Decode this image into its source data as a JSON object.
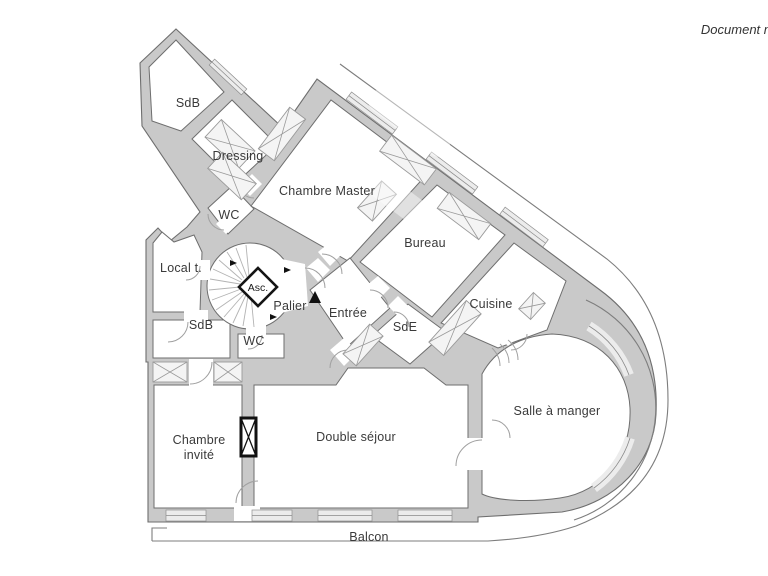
{
  "document": {
    "note": "Document n"
  },
  "colors": {
    "background": "#ffffff",
    "wall_fill": "#c9c9c9",
    "wall_edge": "#6e6e6e",
    "window_fill": "#ececec",
    "text": "#3a3a3a",
    "black": "#111111"
  },
  "rooms": [
    {
      "id": "sdb-top",
      "label": "SdB"
    },
    {
      "id": "dressing",
      "label": "Dressing"
    },
    {
      "id": "chambre-master",
      "label": "Chambre Master"
    },
    {
      "id": "wc-top",
      "label": "WC"
    },
    {
      "id": "bureau",
      "label": "Bureau"
    },
    {
      "id": "local-technique",
      "label": "Local t."
    },
    {
      "id": "ascenseur",
      "label": "Asc."
    },
    {
      "id": "palier",
      "label": "Palier"
    },
    {
      "id": "entree",
      "label": "Entrée"
    },
    {
      "id": "cuisine",
      "label": "Cuisine"
    },
    {
      "id": "sdb-bottom",
      "label": "SdB"
    },
    {
      "id": "wc-bottom",
      "label": "WC"
    },
    {
      "id": "sde",
      "label": "SdE"
    },
    {
      "id": "salle-a-manger",
      "label": "Salle à manger"
    },
    {
      "id": "chambre-invite",
      "label_line1": "Chambre",
      "label_line2": "invité"
    },
    {
      "id": "double-sejour",
      "label": "Double séjour"
    },
    {
      "id": "balcon",
      "label": "Balcon"
    }
  ]
}
